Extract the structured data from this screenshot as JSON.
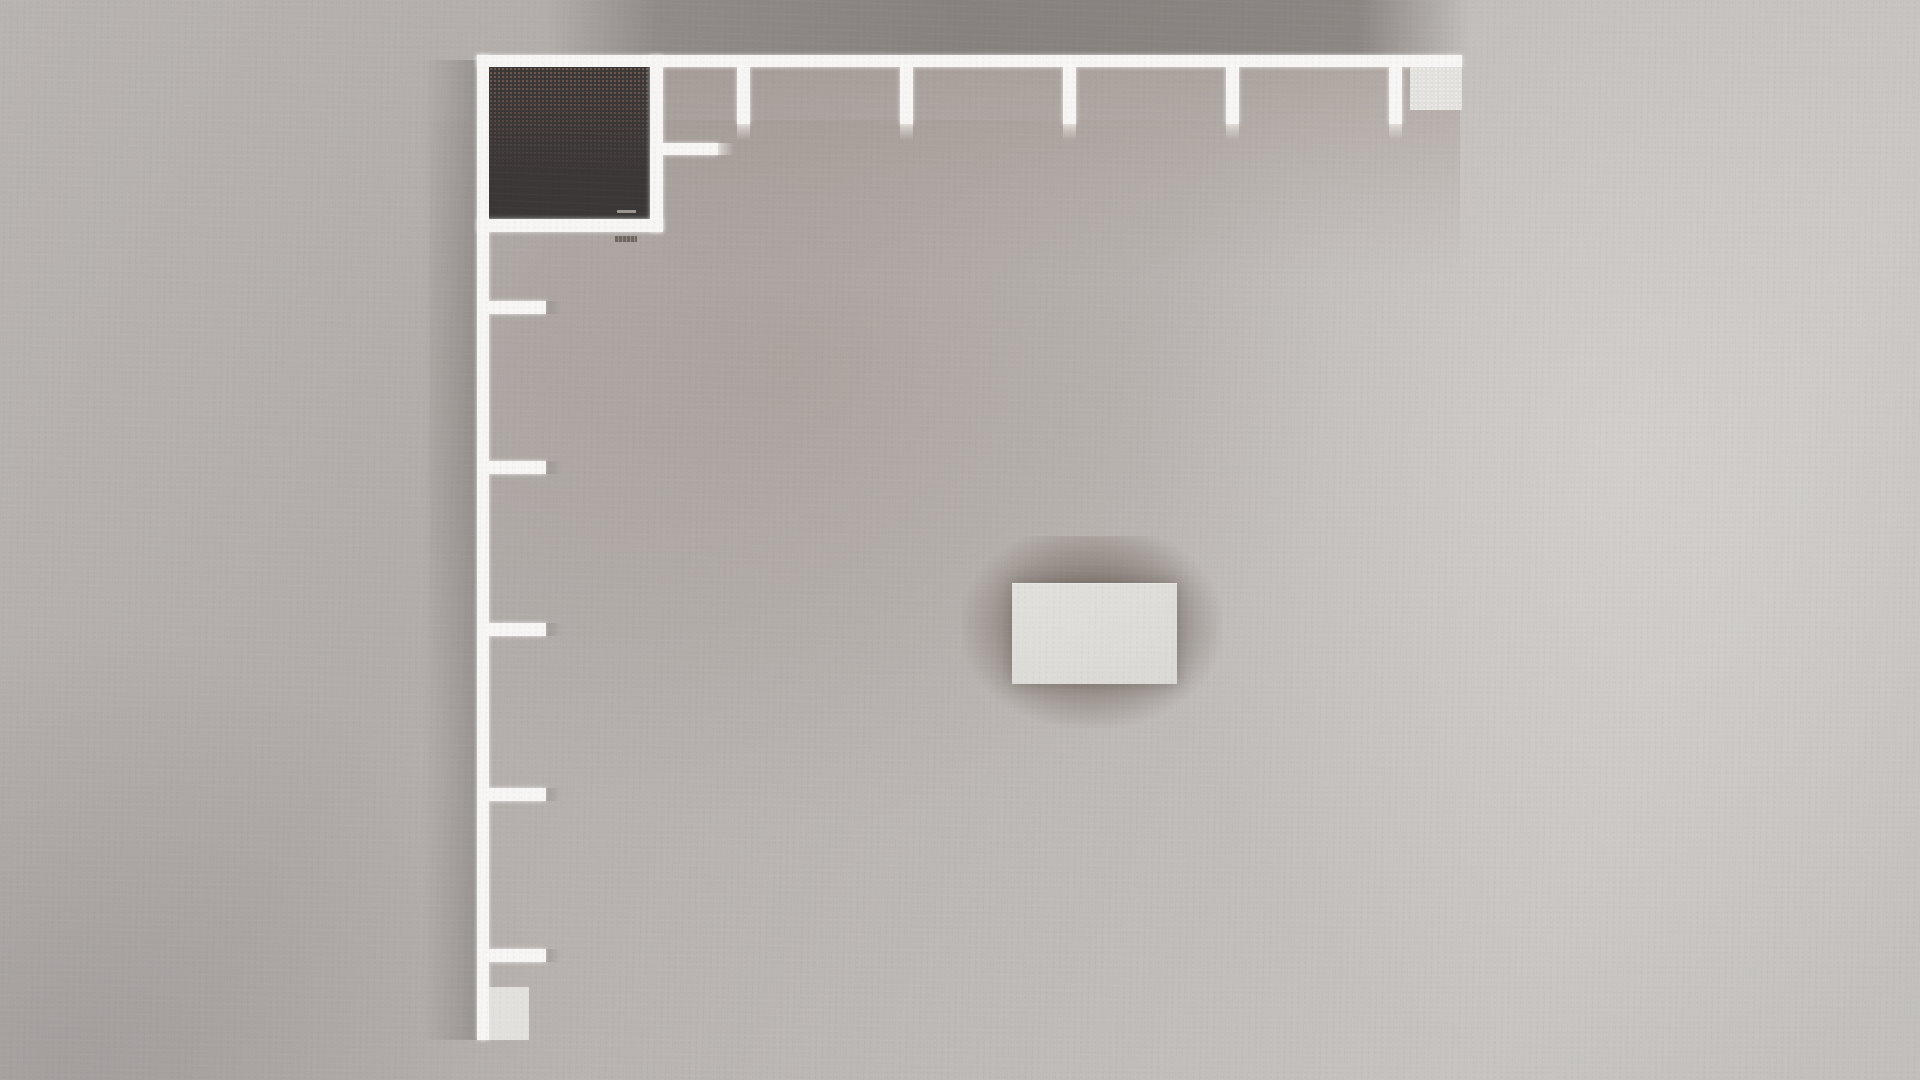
{
  "scene": {
    "description": "Top-down orthographic render of an unfurnished room: L-shaped white perimeter walls (top and left) with five evenly spaced wall stubs on each run, a dark-floored closet room in the top-left corner with inner and outer door handles, small light counter blocks at both wall ends, and a light rectangular box casting a soft shadow near the center of a gray concrete floor.",
    "palette": {
      "wall_white": "#f7f6f4",
      "room_dark": "#3b3737",
      "room_speckle": "#8a6c5f",
      "floor_base": "#bab6b4",
      "shadow_band": "#898480",
      "box_light": "#e3e1de",
      "center_box": "#dedcd9",
      "handle_light": "#9b958f",
      "handle_dark": "#6e6761"
    },
    "objects": [
      {
        "name": "floor-tint-center-left",
        "cls": "tint-radial",
        "x": 430,
        "y": 120,
        "w": 900,
        "h": 700
      },
      {
        "name": "floor-highlight-right",
        "cls": "light-right",
        "x": 1150,
        "y": 0,
        "w": 770,
        "h": 1080
      },
      {
        "name": "floor-vignette-bottom-left",
        "cls": "vignette-bl",
        "x": 0,
        "y": 620,
        "w": 560,
        "h": 460
      },
      {
        "name": "wall-shadow-above-top-wall",
        "cls": "shadow-band",
        "x": 545,
        "y": 0,
        "w": 925,
        "h": 56
      },
      {
        "name": "wall-shadow-left-of-left-wall",
        "cls": "shadow-left",
        "x": 423,
        "y": 60,
        "w": 54,
        "h": 980
      },
      {
        "name": "wall-shadow-below-top-wall",
        "cls": "tint-below",
        "x": 663,
        "y": 67,
        "w": 797,
        "h": 210
      },
      {
        "name": "center-box-shadow",
        "cls": "soft-shadow",
        "x": 962,
        "y": 536,
        "w": 260,
        "h": 192
      },
      {
        "name": "top-wall",
        "cls": "wall",
        "x": 477,
        "y": 55,
        "w": 985,
        "h": 12
      },
      {
        "name": "left-wall",
        "cls": "wall",
        "x": 477,
        "y": 55,
        "w": 12,
        "h": 985
      },
      {
        "name": "closet-interior",
        "cls": "room-dark",
        "x": 489,
        "y": 67,
        "w": 161,
        "h": 152
      },
      {
        "name": "closet-right-wall",
        "cls": "wall",
        "x": 650,
        "y": 55,
        "w": 13,
        "h": 177
      },
      {
        "name": "closet-bottom-wall",
        "cls": "wall",
        "x": 477,
        "y": 219,
        "w": 186,
        "h": 13
      },
      {
        "name": "closet-door-handle-inner",
        "cls": "handle-light",
        "x": 617,
        "y": 210,
        "w": 19,
        "h": 3
      },
      {
        "name": "closet-door-handle-outer",
        "cls": "handle-dark",
        "x": 615,
        "y": 236,
        "w": 22,
        "h": 6
      },
      {
        "name": "closet-side-stub",
        "cls": "wall",
        "x": 663,
        "y": 143,
        "w": 55,
        "h": 12
      },
      {
        "name": "closet-side-stub-remnant",
        "cls": "remnant-light-h",
        "x": 718,
        "y": 143,
        "w": 16,
        "h": 12
      },
      {
        "name": "top-wall-stub-1",
        "cls": "wall",
        "x": 737,
        "y": 67,
        "w": 13,
        "h": 57
      },
      {
        "name": "top-wall-stub-1-remnant",
        "cls": "remnant-light-v",
        "x": 737,
        "y": 124,
        "w": 13,
        "h": 16
      },
      {
        "name": "top-wall-stub-2",
        "cls": "wall",
        "x": 900,
        "y": 67,
        "w": 13,
        "h": 57
      },
      {
        "name": "top-wall-stub-2-remnant",
        "cls": "remnant-light-v",
        "x": 900,
        "y": 124,
        "w": 13,
        "h": 16
      },
      {
        "name": "top-wall-stub-3",
        "cls": "wall",
        "x": 1063,
        "y": 67,
        "w": 13,
        "h": 57
      },
      {
        "name": "top-wall-stub-3-remnant",
        "cls": "remnant-light-v",
        "x": 1063,
        "y": 124,
        "w": 13,
        "h": 16
      },
      {
        "name": "top-wall-stub-4",
        "cls": "wall",
        "x": 1226,
        "y": 67,
        "w": 13,
        "h": 57
      },
      {
        "name": "top-wall-stub-4-remnant",
        "cls": "remnant-light-v",
        "x": 1226,
        "y": 124,
        "w": 13,
        "h": 16
      },
      {
        "name": "top-wall-stub-5",
        "cls": "wall",
        "x": 1389,
        "y": 67,
        "w": 13,
        "h": 57
      },
      {
        "name": "top-wall-stub-5-remnant",
        "cls": "remnant-light-v",
        "x": 1389,
        "y": 124,
        "w": 13,
        "h": 16
      },
      {
        "name": "left-wall-stub-1",
        "cls": "wall",
        "x": 489,
        "y": 301,
        "w": 57,
        "h": 13
      },
      {
        "name": "left-wall-stub-1-remnant",
        "cls": "remnant-dark-h",
        "x": 546,
        "y": 301,
        "w": 15,
        "h": 13
      },
      {
        "name": "left-wall-stub-2",
        "cls": "wall",
        "x": 489,
        "y": 461,
        "w": 57,
        "h": 13
      },
      {
        "name": "left-wall-stub-2-remnant",
        "cls": "remnant-dark-h",
        "x": 546,
        "y": 461,
        "w": 15,
        "h": 13
      },
      {
        "name": "left-wall-stub-3",
        "cls": "wall",
        "x": 489,
        "y": 623,
        "w": 57,
        "h": 13
      },
      {
        "name": "left-wall-stub-3-remnant",
        "cls": "remnant-dark-h",
        "x": 546,
        "y": 623,
        "w": 15,
        "h": 13
      },
      {
        "name": "left-wall-stub-4",
        "cls": "wall",
        "x": 489,
        "y": 788,
        "w": 57,
        "h": 13
      },
      {
        "name": "left-wall-stub-4-remnant",
        "cls": "remnant-dark-h",
        "x": 546,
        "y": 788,
        "w": 15,
        "h": 13
      },
      {
        "name": "left-wall-stub-5",
        "cls": "wall",
        "x": 489,
        "y": 949,
        "w": 57,
        "h": 13
      },
      {
        "name": "left-wall-stub-5-remnant",
        "cls": "remnant-dark-h",
        "x": 546,
        "y": 949,
        "w": 15,
        "h": 13
      },
      {
        "name": "top-wall-end-block",
        "cls": "box-light speckled",
        "x": 1410,
        "y": 67,
        "w": 52,
        "h": 43
      },
      {
        "name": "left-wall-end-block",
        "cls": "box-light",
        "x": 489,
        "y": 987,
        "w": 40,
        "h": 53
      },
      {
        "name": "center-table-top",
        "cls": "box-center",
        "x": 1012,
        "y": 583,
        "w": 165,
        "h": 100
      }
    ]
  }
}
